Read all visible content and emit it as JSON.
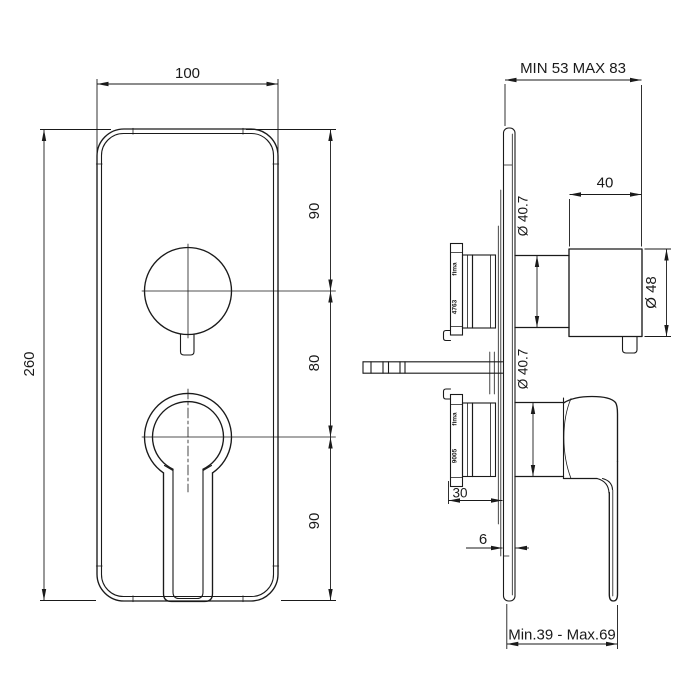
{
  "colors": {
    "line": "#1a1a1a",
    "background": "#ffffff"
  },
  "front_view": {
    "width": "100",
    "height": "260",
    "segments": [
      "90",
      "80",
      "90"
    ]
  },
  "side_view": {
    "depth_range": "MIN 53 MAX 83",
    "knob_depth": "40",
    "knob_diameter": "Ø 48",
    "upper_valve_diameter": "Ø 40.7",
    "lower_valve_diameter": "Ø 40.7",
    "cartridge_depth": "30",
    "plate_thickness": "6",
    "handle_projection": "Min.39 - Max.69",
    "upper_cartridge": {
      "brand": "fima",
      "code": "4763"
    },
    "lower_cartridge": {
      "brand": "fima",
      "code": "9005"
    }
  }
}
